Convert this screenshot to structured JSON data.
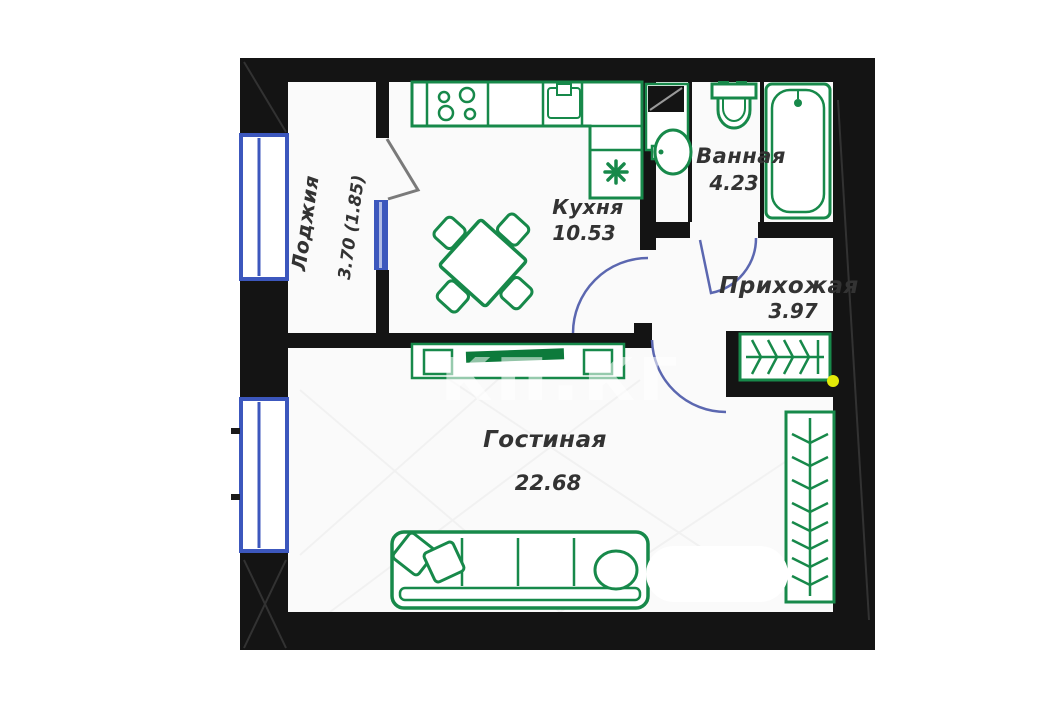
{
  "plan": {
    "title": "Однокомнатная квартира — план",
    "watermark": {
      "text": "кп.кг"
    },
    "rooms": {
      "loggia": {
        "name": "Лоджия",
        "area": "3.70 (1.85)"
      },
      "kitchen": {
        "name": "Кухня",
        "area": "10.53"
      },
      "bathroom": {
        "name": "Ванная",
        "area": "4.23"
      },
      "hallway": {
        "name": "Прихожая",
        "area": "3.97"
      },
      "living": {
        "name": "Гостиная",
        "area": "22.68"
      }
    },
    "colors": {
      "walls": "#141414",
      "furniture": "#17894a",
      "furniture_dark": "#0d7a3b",
      "window": "#3c57bd",
      "door_swing": "#5b67b0",
      "balcony_door": "#7a7a7a",
      "highlight_dot": "#e3ea08",
      "label_text": "#333333",
      "floor": "#fafafa"
    }
  }
}
